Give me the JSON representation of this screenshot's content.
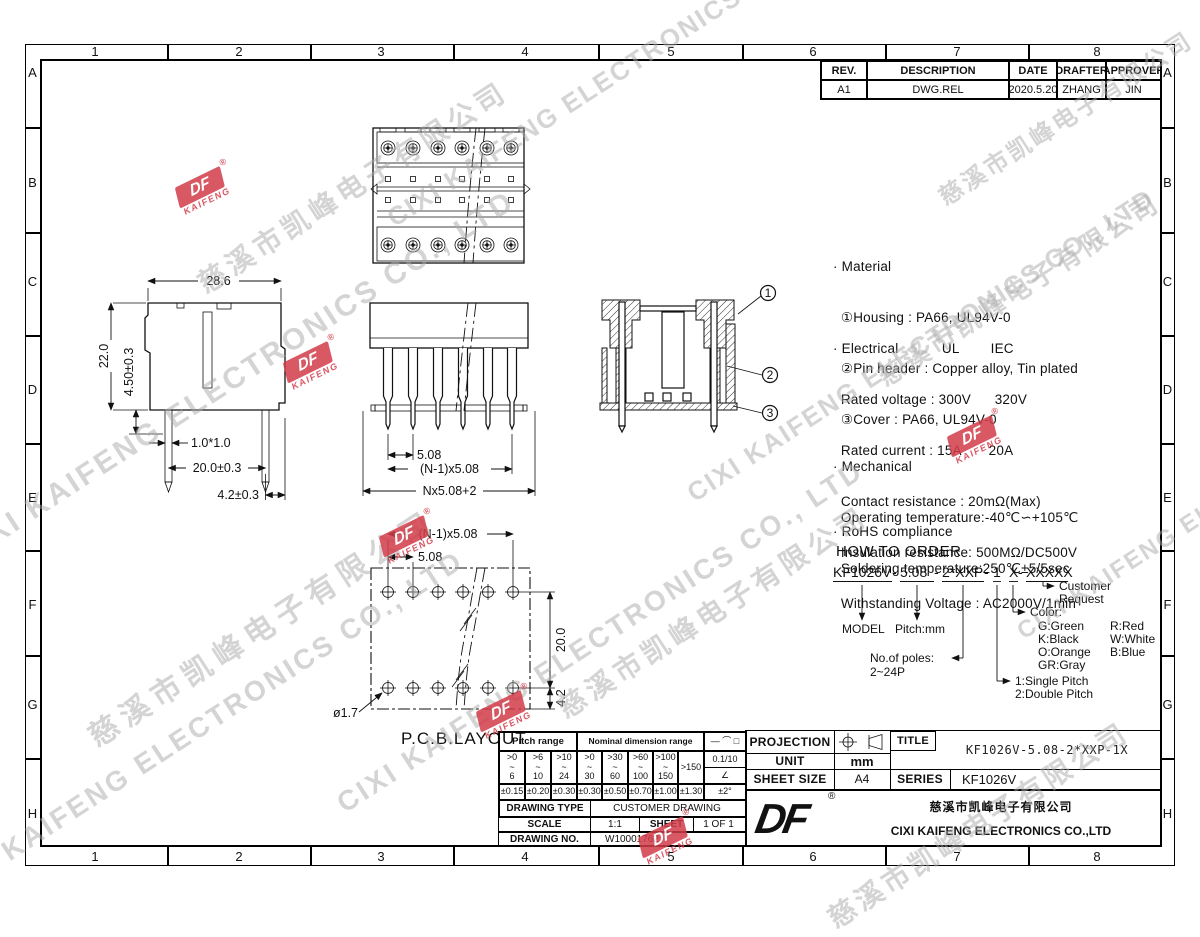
{
  "border": {
    "cols": [
      "1",
      "2",
      "3",
      "4",
      "5",
      "6",
      "7",
      "8"
    ],
    "rows": [
      "A",
      "B",
      "C",
      "D",
      "E",
      "F",
      "G",
      "H"
    ]
  },
  "revision_table": {
    "headers": [
      "REV.",
      "DESCRIPTION",
      "DATE",
      "DRAFTER",
      "APPROVER"
    ],
    "rows": [
      {
        "rev": "A1",
        "description": "DWG.REL",
        "date": "2020.5.20",
        "drafter": "ZHANG",
        "approver": "JIN"
      }
    ]
  },
  "notes": {
    "material": [
      "· Material",
      "  ①Housing : PA66, UL94V-0",
      "  ②Pin header : Copper alloy, Tin plated",
      "  ③Cover : PA66, UL94V-0"
    ],
    "electrical": [
      "· Electrical           UL        IEC",
      "  Rated voltage : 300V      320V",
      "  Rated current : 15A       20A",
      "  Contact resistance : 20mΩ(Max)",
      "  Insulation resistance: 500MΩ/DC500V",
      "  Withstanding Voltage : AC2000V/1min"
    ],
    "mechanical": [
      "· Mechanical",
      "  Operating temperature:-40℃∽+105℃",
      "  Soldering temperature:250℃±5/5sec"
    ],
    "rohs": [
      "· RoHS compliance"
    ]
  },
  "how_to_order": {
    "heading": "HOW TO ORDER",
    "code_parts": [
      "KF1026V",
      "-",
      "5.08",
      "-",
      "2*XXP",
      "-",
      "1",
      " ",
      "X",
      "-",
      "XXXXX"
    ],
    "model": "MODEL",
    "pitch": "Pitch:mm",
    "poles_label": "No.of poles:",
    "poles_range": "2~24P",
    "type1": "1:Single Pitch",
    "type2": "2:Double Pitch",
    "color_label": "Color:",
    "colors_col1": [
      "G:Green",
      "K:Black",
      "O:Orange",
      "GR:Gray"
    ],
    "colors_col2": [
      "R:Red",
      "W:White",
      "B:Blue"
    ],
    "customer_line1": "Customer",
    "customer_line2": "Request"
  },
  "dims": {
    "side": {
      "w": "28.6",
      "h": "22.0",
      "pin_len": "4.50±0.3",
      "pin_sq": "1.0*1.0",
      "row_pitch": "20.0±0.3",
      "edge": "4.2±0.3"
    },
    "front": {
      "pitch": "5.08",
      "np": "(N-1)x5.08",
      "overall": "Nx5.08+2"
    },
    "pcb": {
      "np": "(N-1)x5.08",
      "pitch": "5.08",
      "row": "20.0",
      "edge": "4.2",
      "hole": "ø1.7",
      "label": "P.C.B.LAYOUT"
    },
    "callouts": [
      "1",
      "2",
      "3"
    ]
  },
  "tol_table": {
    "pitch_header": "Pitch range",
    "nominal_header": "Nominal dimension range",
    "symbols": "— ⌒ □",
    "tilde": "~",
    "pitch_ranges": [
      {
        "gt": ">0",
        "to": "6"
      },
      {
        "gt": ">6",
        "to": "10"
      },
      {
        "gt": ">10",
        "to": "24"
      }
    ],
    "nominal_ranges": [
      {
        "gt": ">0",
        "to": "30"
      },
      {
        "gt": ">30",
        "to": "60"
      },
      {
        "gt": ">60",
        "to": "100"
      },
      {
        "gt": ">100",
        "to": "150"
      }
    ],
    "over": ">150",
    "chamfer": "0.1/10",
    "angle": "∠",
    "pitch_tols": [
      "±0.15",
      "±0.20",
      "±0.30"
    ],
    "nominal_tols": [
      "±0.30",
      "±0.50",
      "±0.70",
      "±1.00",
      "±1.30"
    ],
    "angle_tol": "±2°"
  },
  "info_table": {
    "drawing_type_label": "DRAWING TYPE",
    "drawing_type": "CUSTOMER DRAWING",
    "scale_label": "SCALE",
    "scale": "1:1",
    "sheet_label": "SHEET",
    "sheet": "1 OF 1",
    "drawing_no_label": "DRAWING NO.",
    "drawing_no": "W10001762"
  },
  "title_block": {
    "projection_label": "PROJECTION",
    "unit_label": "UNIT",
    "unit": "mm",
    "sheet_size_label": "SHEET SIZE",
    "sheet_size": "A4",
    "title_label": "TITLE",
    "title": "KF1026V-5.08-2*XXP-1X",
    "series_label": "SERIES",
    "series": "KF1026V",
    "company_cn": "慈溪市凯峰电子有限公司",
    "company_en": "CIXI KAIFENG ELECTRONICS CO.,LTD",
    "logo_text": "DF",
    "registered": "®"
  },
  "watermark": {
    "cn": "慈溪市凯峰电子有限公司",
    "en": "CIXI KAIFENG ELECTRONICS CO., LTD",
    "logo_text": "DF",
    "logo_sub": "KAIFENG",
    "registered": "®"
  }
}
